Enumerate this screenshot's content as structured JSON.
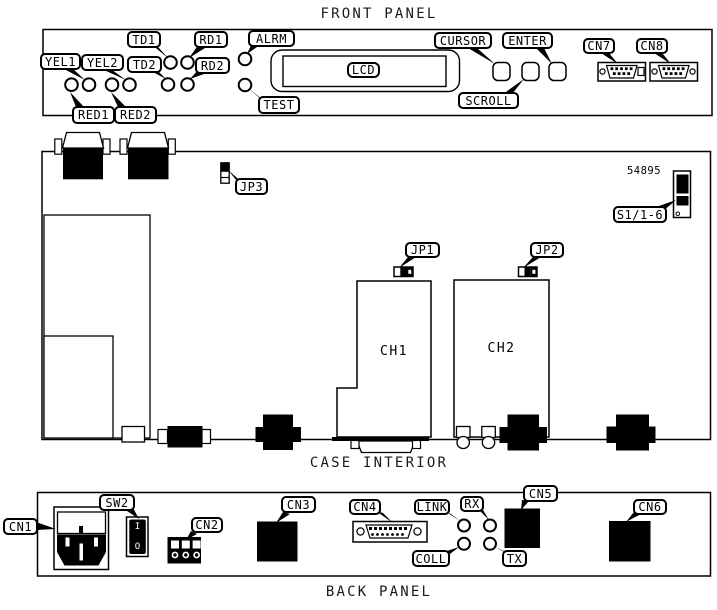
{
  "titles": {
    "front_panel": "FRONT PANEL",
    "case_interior": "CASE INTERIOR",
    "back_panel": "BACK PANEL"
  },
  "front_panel": {
    "led_labels": {
      "yel1": "YEL1",
      "yel2": "YEL2",
      "td1": "TD1",
      "td2": "TD2",
      "rd1": "RD1",
      "rd2": "RD2",
      "red1": "RED1",
      "red2": "RED2",
      "alrm": "ALRM",
      "test": "TEST"
    },
    "display_label": "LCD",
    "buttons": {
      "cursor": "CURSOR",
      "scroll": "SCROLL",
      "enter": "ENTER"
    },
    "connectors": {
      "cn7": "CN7",
      "cn8": "CN8"
    }
  },
  "case_interior": {
    "jumpers": {
      "jp1": "JP1",
      "jp2": "JP2",
      "jp3": "JP3"
    },
    "dip_switch": "S1/1-6",
    "modules": {
      "ch1": "CH1",
      "ch2": "CH2"
    },
    "part_number": "54895"
  },
  "back_panel": {
    "connectors": {
      "cn1": "CN1",
      "cn2": "CN2",
      "cn3": "CN3",
      "cn4": "CN4",
      "cn5": "CN5",
      "cn6": "CN6"
    },
    "switch": {
      "label": "SW2",
      "on_mark": "I",
      "off_mark": "O"
    },
    "leds": {
      "link": "LINK",
      "rx": "RX",
      "tx": "TX",
      "coll": "COLL"
    }
  }
}
